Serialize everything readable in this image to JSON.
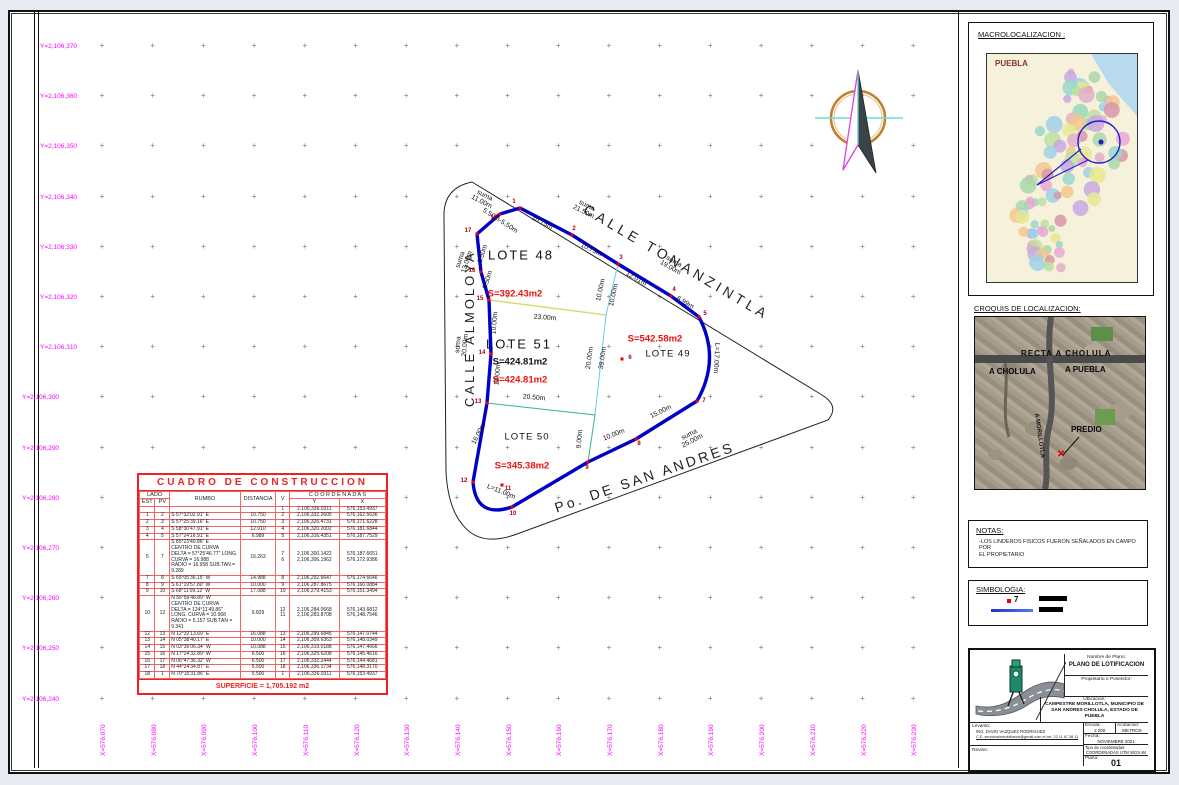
{
  "colors": {
    "grid_label": "#ff00ff",
    "boundary": "#0000c8",
    "area_red": "#ee1111",
    "table_red": "#ee2222",
    "cyan": "#66ccee",
    "green": "#33bb77",
    "yellow": "#d8d860"
  },
  "axes": {
    "y_labels": [
      "Y=2,106,370",
      "Y=2,106,360",
      "Y=2,106,350",
      "Y=2,106,340",
      "Y=2,106,330",
      "Y=2,106,320",
      "Y=2,106,310",
      "Y=2,106,300",
      "Y=2,106,290",
      "Y=2,106,280",
      "Y=2,106,270",
      "Y=2,106,260",
      "Y=2,106,250",
      "Y=2,106,240"
    ],
    "x_labels": [
      "X=576,070",
      "X=576,080",
      "X=576,090",
      "X=576,100",
      "X=576,110",
      "X=576,120",
      "X=576,130",
      "X=576,140",
      "X=576,150",
      "X=576,160",
      "X=576,170",
      "X=576,180",
      "X=576,190",
      "X=576,200",
      "X=576,210",
      "X=576,220",
      "X=576,230"
    ]
  },
  "streets": {
    "tonanzintla": "CALLE  TONANZINTLA",
    "almoloya": "CALLE  ALMOLOYA",
    "san_andres": "Po.  DE  SAN  ANDRES"
  },
  "lots": [
    {
      "t": "LOTE  48",
      "x": 519,
      "y": 253,
      "c": "#111",
      "s": 13,
      "w": 400,
      "ls": 2
    },
    {
      "t": "S=392.43m2",
      "x": 513,
      "y": 292,
      "c": "#ee1111",
      "s": 9.5,
      "w": 700,
      "ls": 0
    },
    {
      "t": "LOTE  51",
      "x": 517,
      "y": 342,
      "c": "#111",
      "s": 13,
      "w": 400,
      "ls": 2
    },
    {
      "t": "S=424.81m2",
      "x": 518,
      "y": 360,
      "c": "#111",
      "s": 9.5,
      "w": 700,
      "ls": 0
    },
    {
      "t": "S=424.81m2",
      "x": 518,
      "y": 378,
      "c": "#ee1111",
      "s": 9.5,
      "w": 700,
      "ls": 0
    },
    {
      "t": "S=542.58m2",
      "x": 653,
      "y": 337,
      "c": "#ee1111",
      "s": 9.5,
      "w": 700,
      "ls": 0
    },
    {
      "t": "LOTE  49",
      "x": 666,
      "y": 352,
      "c": "#111",
      "s": 9.5,
      "w": 400,
      "ls": 1
    },
    {
      "t": "LOTE  50",
      "x": 525,
      "y": 435,
      "c": "#111",
      "s": 9.5,
      "w": 400,
      "ls": 1
    },
    {
      "t": "S=345.38m2",
      "x": 520,
      "y": 464,
      "c": "#ee1111",
      "s": 9.5,
      "w": 700,
      "ls": 0
    }
  ],
  "dims": [
    {
      "t": "suma\n21.50m",
      "x": 583,
      "y": 207,
      "r": 27
    },
    {
      "t": "10.75m",
      "x": 540,
      "y": 221,
      "r": 27
    },
    {
      "t": "10.75m",
      "x": 589,
      "y": 248,
      "r": 27
    },
    {
      "t": "suma\n19.00m",
      "x": 670,
      "y": 263,
      "r": 30
    },
    {
      "t": "12.01m",
      "x": 634,
      "y": 277,
      "r": 30
    },
    {
      "t": "6.99m",
      "x": 683,
      "y": 301,
      "r": 30
    },
    {
      "t": "suma\n11.00m",
      "x": 481,
      "y": 197,
      "r": 27
    },
    {
      "t": "5.50m-5.50m",
      "x": 498,
      "y": 219,
      "r": 33
    },
    {
      "t": "6.50m",
      "x": 481,
      "y": 252,
      "r": -72
    },
    {
      "t": "6.50m",
      "x": 486,
      "y": 278,
      "r": -72
    },
    {
      "t": "suma\n13.00m",
      "x": 462,
      "y": 259,
      "r": -72
    },
    {
      "t": "10.00m",
      "x": 493,
      "y": 321,
      "r": -85
    },
    {
      "t": "suma\n20.00m",
      "x": 460,
      "y": 343,
      "r": -85
    },
    {
      "t": "10.00m",
      "x": 496,
      "y": 372,
      "r": -85
    },
    {
      "t": "16.00m",
      "x": 477,
      "y": 432,
      "r": -62
    },
    {
      "t": "L=11.00m",
      "x": 499,
      "y": 490,
      "r": 22
    },
    {
      "t": "9.00m",
      "x": 578,
      "y": 437,
      "r": -85
    },
    {
      "t": "10.00m",
      "x": 612,
      "y": 433,
      "r": -22
    },
    {
      "t": "15.00m",
      "x": 659,
      "y": 410,
      "r": -27
    },
    {
      "t": "suma\n25.00m",
      "x": 689,
      "y": 436,
      "r": -27
    },
    {
      "t": "L=17.00m",
      "x": 714,
      "y": 356,
      "r": 93
    },
    {
      "t": "10.00m",
      "x": 599,
      "y": 288,
      "r": -78
    },
    {
      "t": "10.00m",
      "x": 612,
      "y": 293,
      "r": -78
    },
    {
      "t": "20.00m",
      "x": 588,
      "y": 356,
      "r": -82
    },
    {
      "t": "39.00m",
      "x": 601,
      "y": 356,
      "r": -82
    },
    {
      "t": "23.00m",
      "x": 543,
      "y": 316,
      "r": 4
    },
    {
      "t": "20.50m",
      "x": 532,
      "y": 396,
      "r": 5
    }
  ],
  "vertices": [
    {
      "n": "1",
      "x": 518,
      "y": 206,
      "lx": 512,
      "ly": 200
    },
    {
      "n": "2",
      "x": 570,
      "y": 233,
      "lx": 572,
      "ly": 227
    },
    {
      "n": "3",
      "x": 616,
      "y": 262,
      "lx": 619,
      "ly": 256
    },
    {
      "n": "4",
      "x": 669,
      "y": 294,
      "lx": 672,
      "ly": 288
    },
    {
      "n": "5",
      "x": 697,
      "y": 315,
      "lx": 703,
      "ly": 312
    },
    {
      "n": "6",
      "x": 620,
      "y": 357,
      "lx": 628,
      "ly": 356
    },
    {
      "n": "7",
      "x": 695,
      "y": 399,
      "lx": 702,
      "ly": 399
    },
    {
      "n": "8",
      "x": 634,
      "y": 437,
      "lx": 637,
      "ly": 442
    },
    {
      "n": "9",
      "x": 586,
      "y": 460,
      "lx": 585,
      "ly": 466
    },
    {
      "n": "10",
      "x": 510,
      "y": 505,
      "lx": 511,
      "ly": 512
    },
    {
      "n": "11",
      "x": 500,
      "y": 483,
      "lx": 506,
      "ly": 487
    },
    {
      "n": "12",
      "x": 471,
      "y": 480,
      "lx": 462,
      "ly": 479
    },
    {
      "n": "13",
      "x": 485,
      "y": 401,
      "lx": 476,
      "ly": 400
    },
    {
      "n": "14",
      "x": 489,
      "y": 352,
      "lx": 480,
      "ly": 351
    },
    {
      "n": "15",
      "x": 487,
      "y": 298,
      "lx": 478,
      "ly": 297
    },
    {
      "n": "16",
      "x": 479,
      "y": 270,
      "lx": 470,
      "ly": 269
    },
    {
      "n": "17",
      "x": 475,
      "y": 232,
      "lx": 466,
      "ly": 229
    },
    {
      "n": "18",
      "x": 498,
      "y": 212,
      "lx": 492,
      "ly": 216
    }
  ],
  "construction_table": {
    "title": "CUADRO DE CONSTRUCCION",
    "headers": {
      "lado": "LADO",
      "est": "EST",
      "pv": "PV",
      "rumbo": "RUMBO",
      "distancia": "DISTANCIA",
      "v": "V",
      "coordenadas": "C O O R D E N A D A S",
      "y": "Y",
      "x": "X"
    },
    "rows": [
      {
        "est": "",
        "pv": "",
        "rum": "",
        "dist": "",
        "v": "1",
        "y": "2,106,336.0311",
        "x": "576,153.4937"
      },
      {
        "est": "1",
        "pv": "2",
        "rum": "S 57°32'02.91\" E",
        "dist": "10.750",
        "v": "2",
        "y": "2,106,332.2605",
        "x": "576,162.5636"
      },
      {
        "est": "2",
        "pv": "3",
        "rum": "S 57°25'39.16\" E",
        "dist": "10.750",
        "v": "3",
        "y": "2,106,326.4731",
        "x": "576,171.6228"
      },
      {
        "est": "3",
        "pv": "4",
        "rum": "S 58°30'47.91\" E",
        "dist": "12.010",
        "v": "4",
        "y": "2,106,320.2002",
        "x": "576,181.6844"
      },
      {
        "est": "4",
        "pv": "5",
        "rum": "S 57°24'16.91\" E",
        "dist": "6.989",
        "v": "5",
        "y": "2,106,316.4351",
        "x": "576,187.7529"
      },
      {
        "est": "5",
        "pv": "7",
        "rum": "S 85°23'40.86\" E\nCENTRO DE CURVA\nDELTA = 57°25'46.77\"  LONG. CURVA = 16.988\nRADIO = 16.958    SUB.TAN = 9.289",
        "dist": "16.263",
        "v": "7\n6",
        "y": "2,106,300.1422\n2,106,306.1962",
        "x": "576,187.6651\n576,172.9386"
      },
      {
        "est": "7",
        "pv": "8",
        "rum": "S 65°05'36.15\" W",
        "dist": "14.988",
        "v": "8",
        "y": "2,106,292.6647",
        "x": "576,174.6646"
      },
      {
        "est": "8",
        "pv": "9",
        "rum": "S 61°19'57.80\" W",
        "dist": "10.000",
        "v": "9",
        "y": "2,106,287.8675",
        "x": "576,166.0884"
      },
      {
        "est": "9",
        "pv": "10",
        "rum": "S 68°11'09.12\" W",
        "dist": "17.088",
        "v": "10",
        "y": "2,106,279.4153",
        "x": "576,151.3494"
      },
      {
        "est": "10",
        "pv": "12",
        "rum": "N 56°59'48.89\" W\nCENTRO DE CURVA\nDELTA = 124°11'49.86\"  LONG. CURVA = 10.968\nRADIO = 5.157    SUB.TAN = 9.341",
        "dist": "9.829",
        "v": "12\n11",
        "y": "2,106,284.0668\n2,106,283.8708",
        "x": "576,143.6812\n576,148.7546"
      },
      {
        "est": "12",
        "pv": "13",
        "rum": "N 12°32'13.69\" E",
        "dist": "16.088",
        "v": "13",
        "y": "2,106,299.6845",
        "x": "576,147.0744"
      },
      {
        "est": "13",
        "pv": "14",
        "rum": "N 05°38'40.17\" E",
        "dist": "10.000",
        "v": "14",
        "y": "2,106,309.6363",
        "x": "576,148.0349"
      },
      {
        "est": "14",
        "pv": "15",
        "rum": "N 03°36'06.34\" W",
        "dist": "10.088",
        "v": "15",
        "y": "2,106,319.0188",
        "x": "576,147.4666"
      },
      {
        "est": "15",
        "pv": "16",
        "rum": "N 17°24'32.89\" W",
        "dist": "6.500",
        "v": "16",
        "y": "2,106,325.6208",
        "x": "576,145.4616"
      },
      {
        "est": "16",
        "pv": "17",
        "rum": "N 06°47'36.32\" W",
        "dist": "6.500",
        "v": "17",
        "y": "2,106,332.2444",
        "x": "576,144.4681"
      },
      {
        "est": "17",
        "pv": "18",
        "rum": "N 44°24'34.87\" E",
        "dist": "5.500",
        "v": "18",
        "y": "2,106,336.1734",
        "x": "576,148.3170"
      },
      {
        "est": "18",
        "pv": "1",
        "rum": "N 70°15'31.86\" E",
        "dist": "5.500",
        "v": "1",
        "y": "2,106,336.0311",
        "x": "576,153.4937"
      }
    ],
    "superficie": "SUPERFICIE = 1,705.192 m2"
  },
  "panel": {
    "macro": {
      "title": "MACROLOCALIZACION :",
      "map_title": "PUEBLA"
    },
    "croquis": {
      "title": "CROQUIS DE LOCALIZACION:",
      "recta": "RECTA A CHOLULA",
      "a_cholula": "A CHOLULA",
      "a_puebla": "A PUEBLA",
      "predio": "PREDIO",
      "road": "A MORILLOTLA",
      "marker": "✕"
    },
    "notas": {
      "title": "NOTAS:",
      "line1": "-LOS  LINDEROS FISICOS FUERON SEÑALADOS EN CAMPO POR",
      "line2": "EL PROPIETARIO"
    },
    "simbologia": {
      "title": "SIMBOLOGIA:",
      "vertex_num": "7"
    },
    "titleblock": {
      "nombre_label": "Nombre de Plano:",
      "nombre": "PLANO DE LOTIFICACION",
      "prop_label": "Propietario o Poseedor:",
      "ubic_label": "Ubicacion:",
      "ubicacion": "CAMPESTRE MORILLOTLA, MUNICIPIO DE\nSAN ANDRES CHOLULA, ESTADO DE\nPUEBLA",
      "levanto_label": "Levanto:",
      "levanto_name": "ING. DAVID VAZQUEZ RODRIGUEZ",
      "levanto_contact": "C.E. serviciosinmobiliarios@gmail.com    el cel. 22 11 87 38 11",
      "reviso_label": "Reviso:",
      "escala_label": "Escala:",
      "escala": "1:200",
      "acot_label": "Acotacion:",
      "acot": "METROS",
      "fecha_label": "Fecha:",
      "fecha": "NOVIEMBRE 2021",
      "tipo_label": "Tipo de coordenadas:",
      "tipo": "COORDENADAS UTM WGS-84",
      "plano_label": "Plano:",
      "plano": "01"
    }
  }
}
